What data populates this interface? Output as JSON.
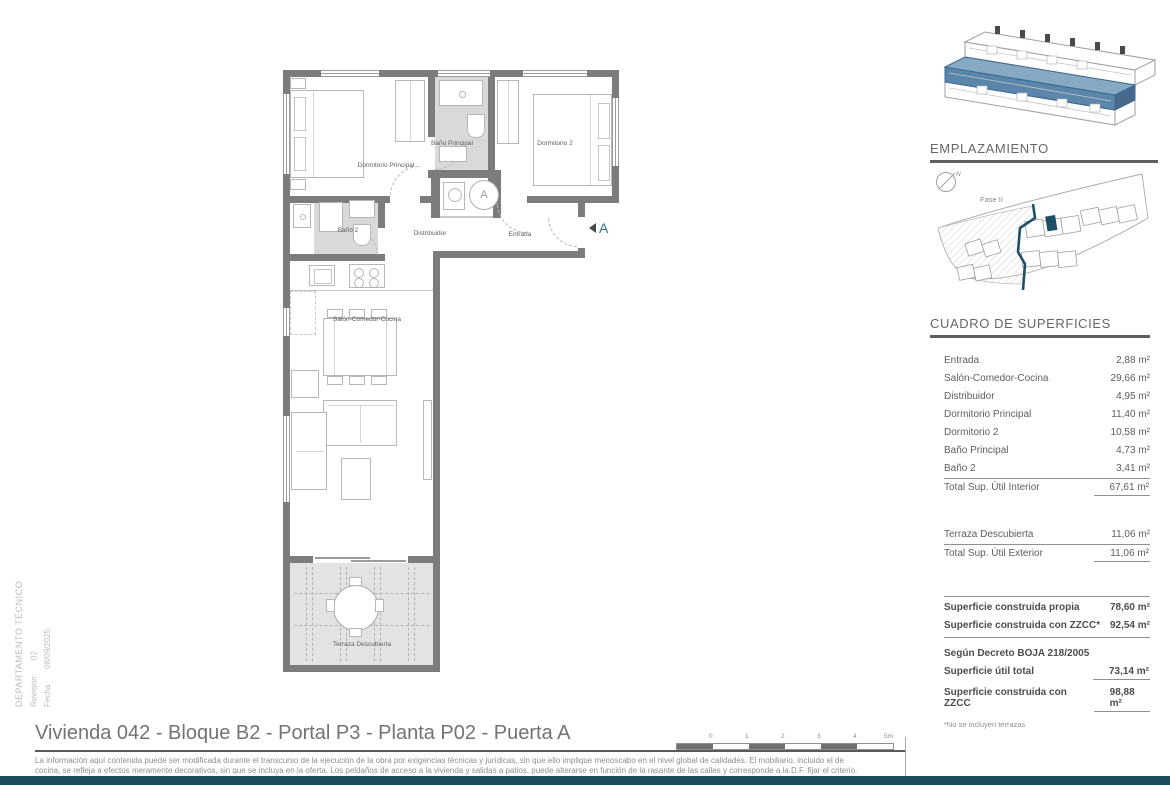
{
  "meta": {
    "department": "DEPARTAMENTO TÉCNICO",
    "revision_label": "Revisión:",
    "revision_value": "02",
    "date_label": "Fecha:",
    "date_value": "08/09/2025"
  },
  "plan": {
    "labels": {
      "dormitorio_principal": "Dormitorio Principal",
      "bano_principal": "Baño Principal",
      "dormitorio_2": "Dormitorio 2",
      "bano_2": "Baño 2",
      "distribuidor": "Distribuidor",
      "entrada": "Entrada",
      "salon": "Salón-Comedor-Cocina",
      "terraza": "Terraza Descubierta"
    },
    "section_marker": "A",
    "appliance_letter": "A"
  },
  "emplazamiento": {
    "title": "EMPLAZAMIENTO",
    "fase": "Fase II",
    "north": "N",
    "accent_color": "#1e4f66"
  },
  "surfaces": {
    "title": "CUADRO DE SUPERFICIES",
    "rows": [
      {
        "label": "Entrada",
        "value": "2,88 m²"
      },
      {
        "label": "Salón-Comedor-Cocina",
        "value": "29,66 m²"
      },
      {
        "label": "Distribuidor",
        "value": "4,95 m²"
      },
      {
        "label": "Dormitorio Principal",
        "value": "11,40 m²"
      },
      {
        "label": "Dormitorio 2",
        "value": "10,58 m²"
      },
      {
        "label": "Baño Principal",
        "value": "4,73 m²"
      },
      {
        "label": "Baño 2",
        "value": "3,41 m²"
      }
    ],
    "total_interior": {
      "label": "Total Sup. Útil Interior",
      "value": "67,61 m²"
    },
    "exterior_row": {
      "label": "Terraza Descubierta",
      "value": "11,06 m²"
    },
    "total_exterior": {
      "label": "Total Sup. Útil Exterior",
      "value": "11,06 m²"
    },
    "construida": [
      {
        "label": "Superficie construida propia",
        "value": "78,60 m²"
      },
      {
        "label": "Superficie construida con ZZCC*",
        "value": "92,54 m²"
      }
    ],
    "decreto_heading": "Según Decreto BOJA 218/2005",
    "decreto": [
      {
        "label": "Superficie útil total",
        "value": "73,14 m²"
      },
      {
        "label": "Superficie construida con ZZCC",
        "value": "98,88 m²"
      }
    ],
    "footnote": "*No se incluyen terrazas"
  },
  "footer": {
    "title": "Vivienda 042 - Bloque B2 - Portal P3 - Planta P02 - Puerta A",
    "disclaimer_line1": "La información aquí contenida puede ser modificada durante el transcurso de la ejecución de la obra por exigencias técnicas y jurídicas, sin que ello implique menoscabo en el nivel global de calidades. El mobiliario, incluido el de",
    "disclaimer_line2": "cocina, se refleja a efectos meramente decorativos, sin que se incluya en la oferta. Los peldaños de acceso a la vivienda y salidas a patios, puede alterarse en función de la rasante de las calles y corresponde a la D.F. fijar el criterio.",
    "scale_labels": [
      "0",
      "1",
      "2",
      "3",
      "4",
      "5m"
    ]
  }
}
